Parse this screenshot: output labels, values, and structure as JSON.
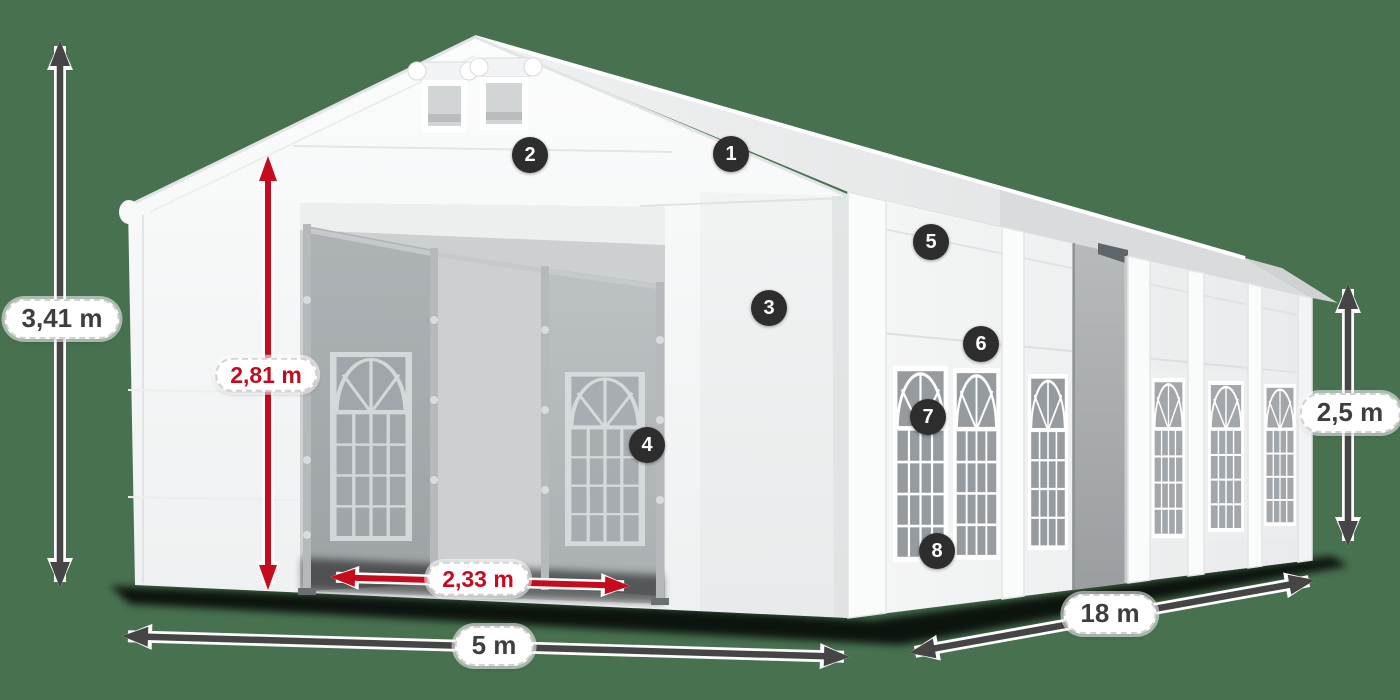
{
  "diagram": {
    "subject": "tent-dimension-illustration",
    "background_color": "#487150"
  },
  "dimensions": {
    "total_height": {
      "label": "3,41 m",
      "arrow": "vertical-double-arrow",
      "color": "#454545"
    },
    "door_height": {
      "label": "2,81 m",
      "arrow": "vertical-double-arrow",
      "color": "#c60b1e"
    },
    "door_width": {
      "label": "2,33 m",
      "arrow": "horizontal-double-arrow",
      "color": "#c60b1e"
    },
    "front_width": {
      "label": "5 m",
      "arrow": "horizontal-double-arrow",
      "color": "#454545"
    },
    "side_length": {
      "label": "18 m",
      "arrow": "diagonal-double-arrow",
      "color": "#454545"
    },
    "side_height": {
      "label": "2,5 m",
      "arrow": "vertical-double-arrow",
      "color": "#454545"
    }
  },
  "markers": [
    "1",
    "2",
    "3",
    "4",
    "5",
    "6",
    "7",
    "8"
  ],
  "colors": {
    "background": "#487150",
    "tent_white": "#f6f7f7",
    "interior_gray": "#a6abae",
    "glass_gray": "#969ba0",
    "arrow_dark": "#454545",
    "arrow_red": "#c60b1e",
    "marker_background": "#2d2d2d",
    "marker_text": "#ffffff",
    "label_background": "#ffffff",
    "label_border": "#d2d2d2",
    "label_text_dark": "#3e3e3e",
    "label_text_red": "#c60b1e"
  }
}
